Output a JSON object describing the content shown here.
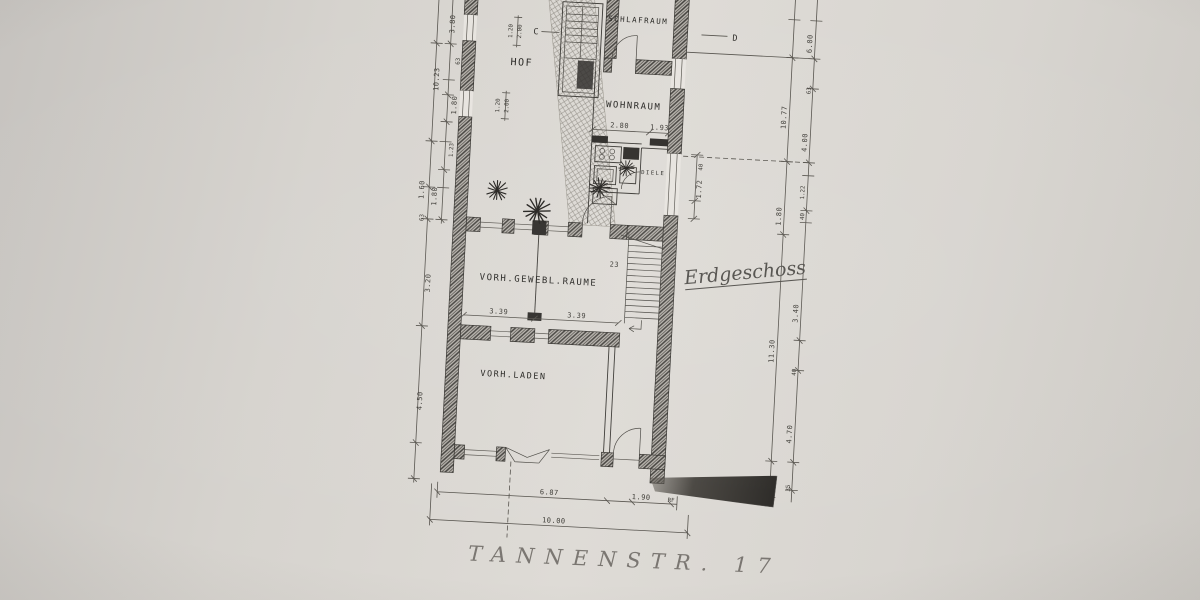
{
  "palette": {
    "paper": "#d8d5d0",
    "ink": "#2e2c29",
    "dim_ink": "#55524c",
    "pencil": "#7a7671",
    "shadow": "#2b2926"
  },
  "rooms": {
    "schlafraum": "SCHLAFRAUM",
    "wohnraum": "WOHNRAUM",
    "diele": "DIELE",
    "hof": "HOF",
    "gewerbliche": "VORH.GEWEBL.RAUME",
    "laden": "VORH.LADEN"
  },
  "annotations": {
    "floor": "Erdgeschoss",
    "street": "TANNENSTR. 17",
    "section_c": "C",
    "section_d": "D",
    "stair_steps": "23"
  },
  "dims": {
    "left": {
      "a": "3.80",
      "b": "10.23",
      "c": "63",
      "d": "1.80",
      "e": "1.23",
      "f": "1.60",
      "g": "1.80",
      "h": "63",
      "i": "3.20",
      "j": "4.50"
    },
    "gates": {
      "a1": "1.20",
      "a2": "2.00",
      "b1": "1.20",
      "b2": "2.00"
    },
    "right_inner": {
      "a": "10.77",
      "b": "1.80",
      "c": "11.30"
    },
    "right_outer": {
      "a": "6.00",
      "b": "63",
      "c": "4.00",
      "d": "1.22",
      "e": "40",
      "f": "3.40",
      "g": "40",
      "h": "4.70",
      "i": "35"
    },
    "wohnraum": {
      "a": "2.80",
      "b": "1.93"
    },
    "window": {
      "a": "40",
      "b": "1.72"
    },
    "gewerbl": {
      "a": "3.39",
      "b": "3.39"
    },
    "bottom": {
      "a": "6.87",
      "b": "1.90",
      "c": "RF",
      "total": "10.00"
    }
  }
}
